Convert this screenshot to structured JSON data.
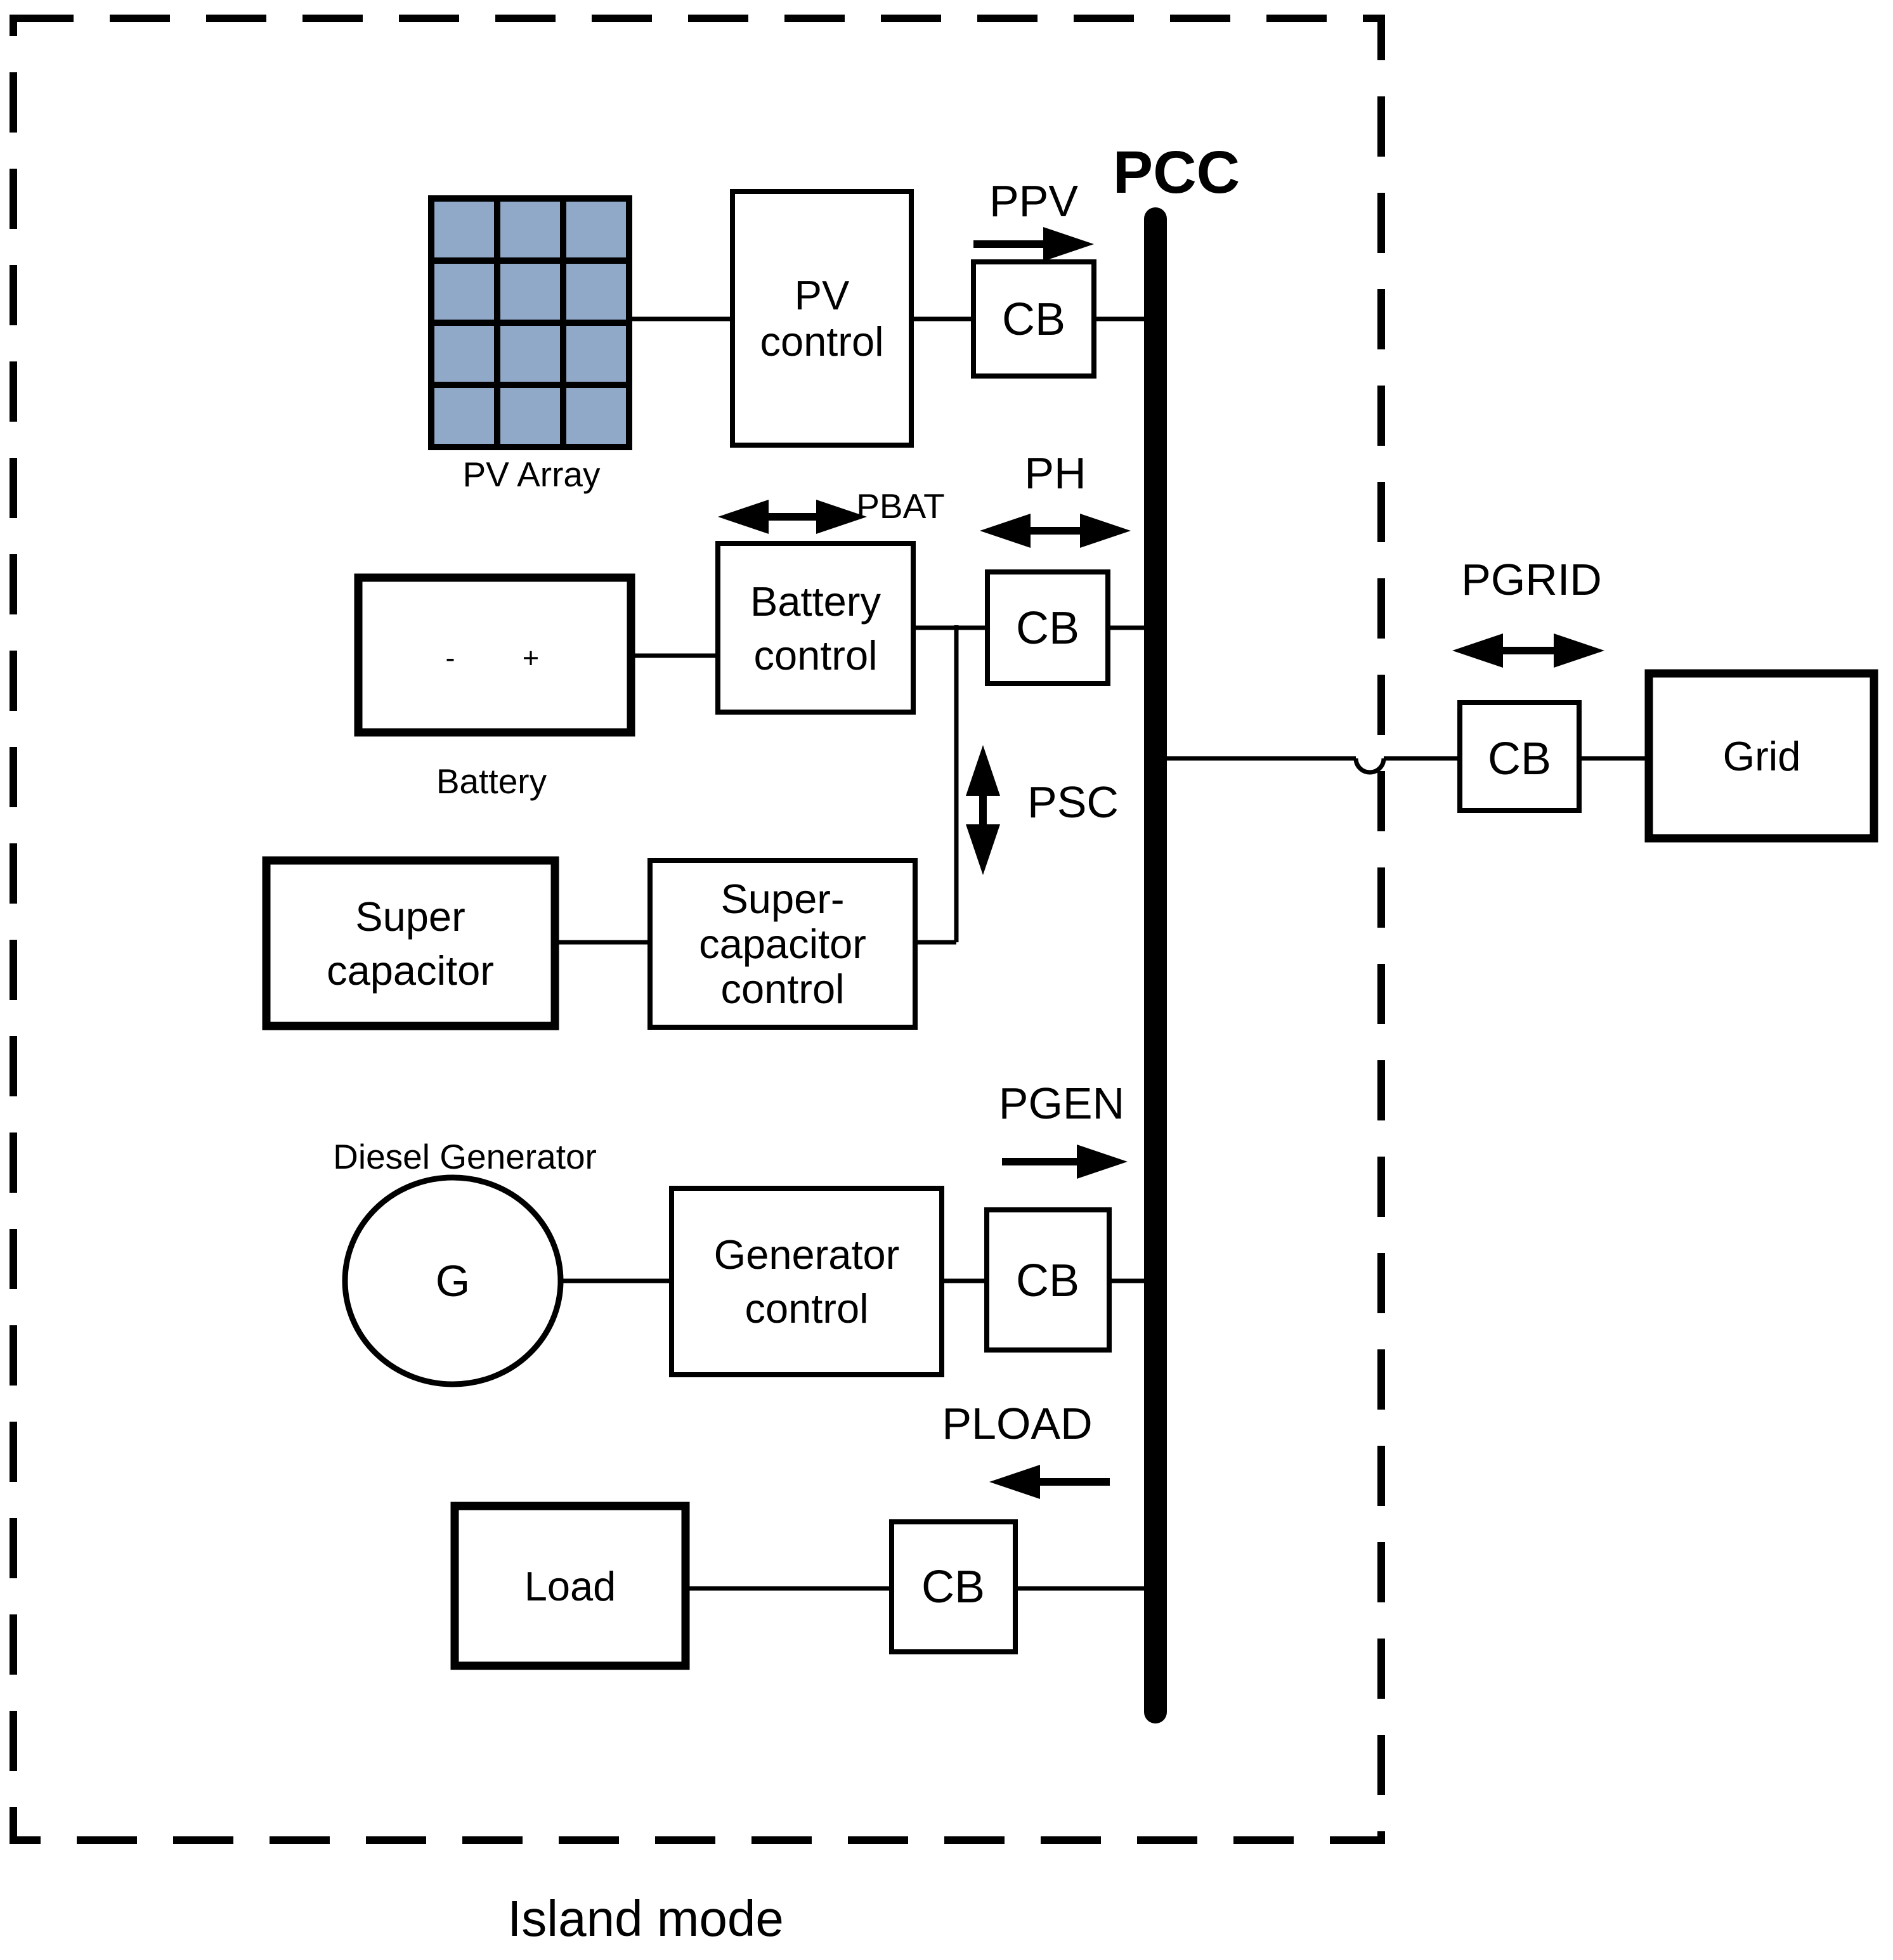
{
  "diagram": {
    "mode_label": "Island mode",
    "bus": {
      "label": "PCC"
    },
    "cb": {
      "label": "CB"
    },
    "pv": {
      "array_label": "PV Array",
      "control_line1": "PV",
      "control_line2": "control",
      "flow_label": "PPV"
    },
    "battery": {
      "label": "Battery",
      "minus": "-",
      "plus": "+",
      "control_line1": "Battery",
      "control_line2": "control",
      "flow_label": "PBAT",
      "bus_flow_label": "PH"
    },
    "supercapacitor": {
      "line1": "Super",
      "line2": "capacitor",
      "control_line1": "Super-",
      "control_line2": "capacitor",
      "control_line3": "control",
      "flow_label": "PSC"
    },
    "generator": {
      "label": "Diesel Generator",
      "symbol": "G",
      "control_line1": "Generator",
      "control_line2": "control",
      "flow_label": "PGEN"
    },
    "load": {
      "label": "Load",
      "flow_label": "PLOAD"
    },
    "grid": {
      "label": "Grid",
      "flow_label": "PGRID"
    },
    "colors": {
      "pv_cell": "#91A9C9",
      "line": "#000000",
      "background": "#FFFFFF"
    }
  }
}
